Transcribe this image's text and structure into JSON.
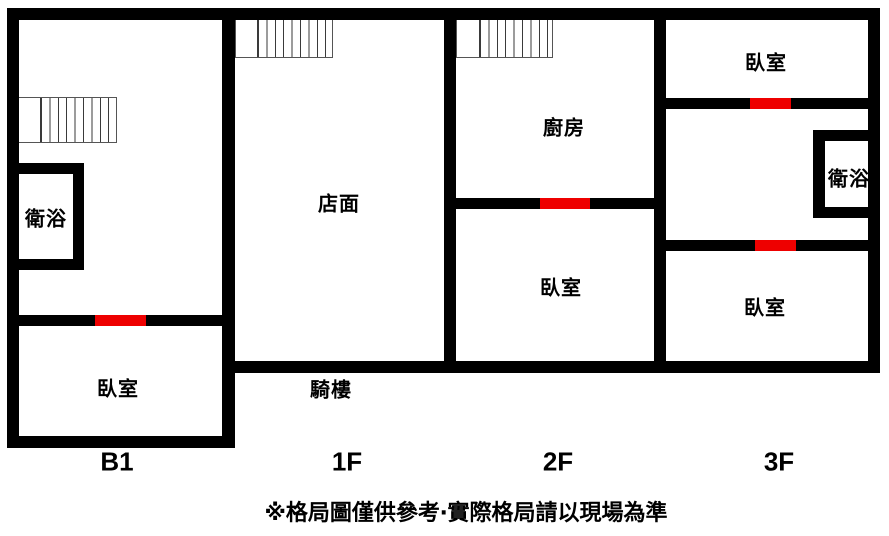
{
  "floors": [
    {
      "label": "B1",
      "rooms": [
        {
          "name": "衛浴"
        },
        {
          "name": "臥室"
        }
      ]
    },
    {
      "label": "1F",
      "rooms": [
        {
          "name": "店面"
        },
        {
          "name": "騎樓"
        }
      ]
    },
    {
      "label": "2F",
      "rooms": [
        {
          "name": "廚房"
        },
        {
          "name": "臥室"
        }
      ]
    },
    {
      "label": "3F",
      "rooms": [
        {
          "name": "臥室"
        },
        {
          "name": "衛浴"
        },
        {
          "name": "臥室"
        }
      ]
    }
  ],
  "disclaimer": "※格局圖僅供參考‧實際格局請以現場為準",
  "colors": {
    "wall": "#000000",
    "door_marker": "#ee0000",
    "background": "#ffffff",
    "stairs_line": "#3a3a3a"
  }
}
